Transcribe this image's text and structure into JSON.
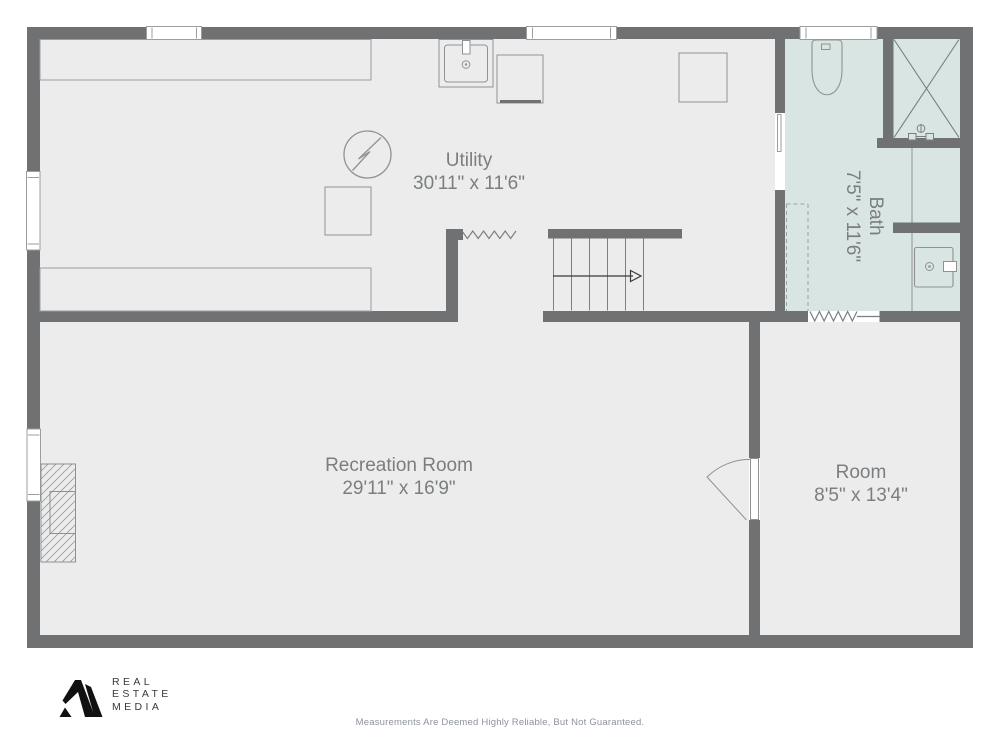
{
  "plan": {
    "rooms": [
      {
        "id": "utility",
        "name": "Utility",
        "dimensions": "30'11\" x 11'6\""
      },
      {
        "id": "bath",
        "name": "Bath",
        "dimensions": "7'5\" x 11'6\""
      },
      {
        "id": "recreation",
        "name": "Recreation Room",
        "dimensions": "29'11\" x 16'9\""
      },
      {
        "id": "room",
        "name": "Room",
        "dimensions": "8'5\" x 13'4\""
      }
    ],
    "fixtures": [
      "sink",
      "washer",
      "dryer",
      "electrical-panel",
      "stairs",
      "toilet",
      "shower",
      "vanity-sink",
      "fireplace",
      "door",
      "windows"
    ],
    "colors": {
      "wall": "#6f7172",
      "floor": "#ececec",
      "bath_floor": "#d9e5e3",
      "label_text": "#7b7e80"
    }
  },
  "branding": {
    "logo_lines": [
      "REAL",
      "ESTATE",
      "MEDIA"
    ]
  },
  "footer": {
    "disclaimer": "Measurements Are Deemed Highly Reliable, But Not Guaranteed."
  }
}
